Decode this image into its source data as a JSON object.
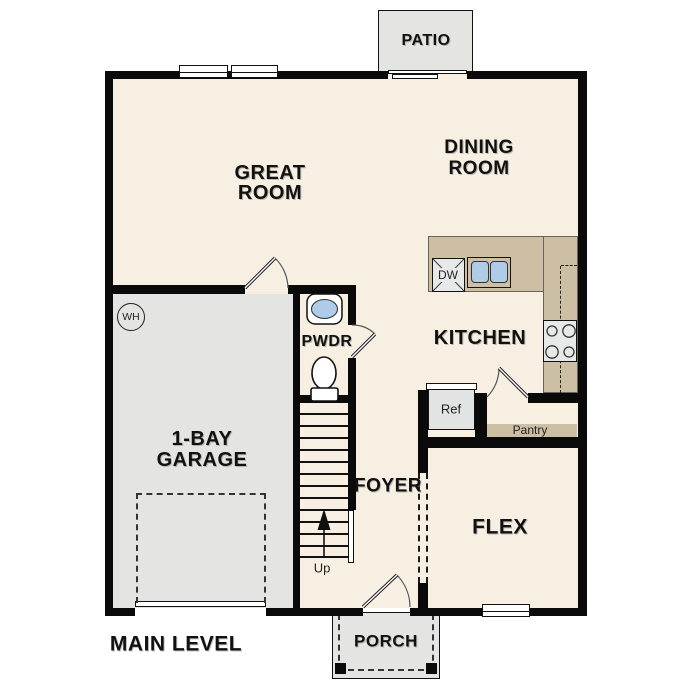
{
  "colors": {
    "floor": "#f7efe2",
    "outdoor": "#e4e4e2",
    "counter": "#cdbfa4",
    "fixture": "#e7e8e8",
    "water": "#aecbe8",
    "wall": "#0a0a0a",
    "ink": "#111111"
  },
  "plan": {
    "level_label": "MAIN LEVEL",
    "rooms": {
      "great_room": "GREAT\nROOM",
      "dining_room": "DINING\nROOM",
      "kitchen": "KITCHEN",
      "garage": "1-BAY\nGARAGE",
      "pwdr": "PWDR",
      "foyer": "FOYER",
      "flex": "FLEX"
    },
    "outdoor_areas": {
      "patio": "PATIO",
      "porch": "PORCH"
    },
    "fixtures": {
      "water_heater": "WH",
      "dishwasher": "DW",
      "refrigerator": "Ref",
      "pantry": "Pantry",
      "stairs_direction": "Up"
    }
  }
}
